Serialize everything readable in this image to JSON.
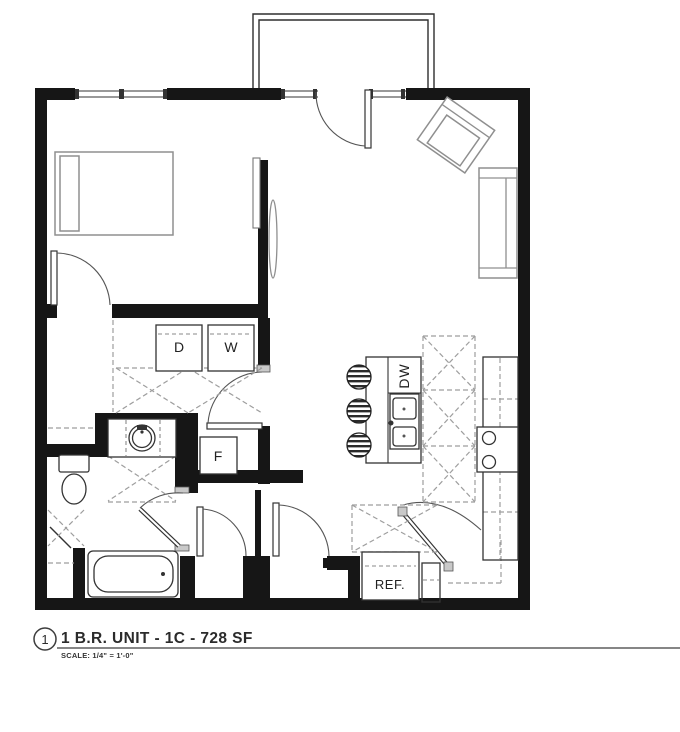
{
  "drawing": {
    "type": "architectural floor plan",
    "labels": {
      "dryer": "D",
      "washer": "W",
      "furnace_closet": "F",
      "dishwasher": "DW",
      "refrigerator": "REF."
    },
    "title_block": {
      "sheet_number": "1",
      "title": "1 B.R. UNIT  -  1C - 728 SF",
      "scale": "SCALE: 1/4\" = 1'-0\""
    },
    "colors": {
      "wall": "#161616",
      "fixture_line": "#333333",
      "furniture_line": "#8f8f8f",
      "dashed_line": "#9e9e9e",
      "background": "#ffffff"
    }
  }
}
